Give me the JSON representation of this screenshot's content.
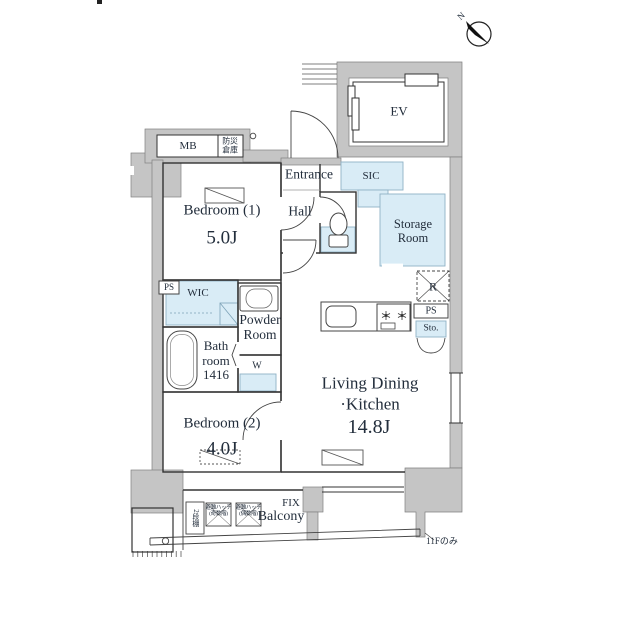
{
  "page": {
    "background": "#ffffff"
  },
  "compass": {
    "north_label": "N"
  },
  "labels": {
    "mb": "MB",
    "disaster_storage_line1": "防災",
    "disaster_storage_line2": "倉庫",
    "ev": "EV",
    "entrance": "Entrance",
    "hall": "Hall",
    "sic": "SIC",
    "storage_room": "Storage Room",
    "bedroom1_name": "Bedroom (1)",
    "bedroom1_size": "5.0J",
    "ps_left": "PS",
    "wic": "WIC",
    "powder_room": "Powder Room",
    "bathroom": "Bath room 1416",
    "washer": "W",
    "bedroom2_name": "Bedroom (2)",
    "bedroom2_size": "4.0J",
    "ldk_line1": "Living Dining",
    "ldk_line2": "·Kitchen",
    "ldk_size": "14.8J",
    "refrigerator": "R",
    "ps_right": "PS",
    "storage_small": "Sto.",
    "fix": "FIX",
    "balcony": "Balcony",
    "shelf": "2段棚",
    "hatch1_line1": "避難ハッチ",
    "hatch1_line2": "(奇数階)",
    "hatch2_line1": "避難ハッチ",
    "hatch2_line2": "(偶数階)",
    "floor_note": "11Fのみ"
  },
  "colors": {
    "wall": "#c5c5c5",
    "closet": "#d9ecf6",
    "line": "#333333",
    "text": "#232e3c"
  }
}
